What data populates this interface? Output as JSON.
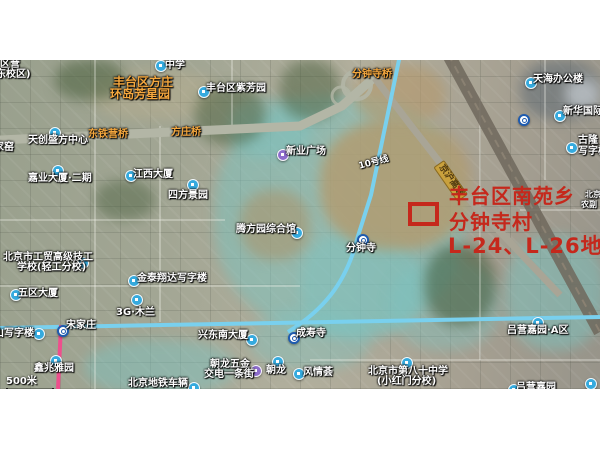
{
  "window": {
    "width": 600,
    "height": 450,
    "background": "#ffffff"
  },
  "map": {
    "type": "satellite-map",
    "scale_bar": {
      "label": "500米"
    },
    "metro_line_label": "10号线",
    "labels": [
      {
        "text": "区营",
        "x": 0,
        "y": 0,
        "cls": ""
      },
      {
        "text": "东校区)",
        "x": -4,
        "y": 10,
        "cls": ""
      },
      {
        "text": "中学",
        "x": 165,
        "y": 1,
        "cls": ""
      },
      {
        "text": "丰台区方庄",
        "x": 113,
        "y": 16,
        "cls": "orange",
        "size": 12
      },
      {
        "text": "环岛芳星园",
        "x": 110,
        "y": 28,
        "cls": "orange",
        "size": 12
      },
      {
        "text": "丰台区紫芳园",
        "x": 206,
        "y": 24,
        "cls": ""
      },
      {
        "text": "分钟寺桥",
        "x": 352,
        "y": 10,
        "cls": "orange"
      },
      {
        "text": "天海办公楼",
        "x": 533,
        "y": 15,
        "cls": ""
      },
      {
        "text": "新华国际广",
        "x": 563,
        "y": 47,
        "cls": ""
      },
      {
        "text": "古隆",
        "x": 578,
        "y": 76,
        "cls": ""
      },
      {
        "text": "写字楼",
        "x": 578,
        "y": 87,
        "cls": ""
      },
      {
        "text": "东铁营桥",
        "x": 88,
        "y": 70,
        "cls": "orange"
      },
      {
        "text": "方庄桥",
        "x": 171,
        "y": 68,
        "cls": "orange"
      },
      {
        "text": "天创盛方中心",
        "x": 28,
        "y": 76,
        "cls": ""
      },
      {
        "text": "家窑",
        "x": -6,
        "y": 83,
        "cls": ""
      },
      {
        "text": "新业广场",
        "x": 286,
        "y": 87,
        "cls": ""
      },
      {
        "text": "10号线",
        "x": 358,
        "y": 103,
        "cls": "metrolbl",
        "rot": -15
      },
      {
        "text": "京沪高速",
        "x": 444,
        "y": 100,
        "cls": "roadtag",
        "rot": 55
      },
      {
        "text": "嘉业大厦·二期",
        "x": 28,
        "y": 114,
        "cls": ""
      },
      {
        "text": "江西大厦",
        "x": 133,
        "y": 110,
        "cls": ""
      },
      {
        "text": "四方景园",
        "x": 168,
        "y": 131,
        "cls": ""
      },
      {
        "text": "北京",
        "x": 585,
        "y": 131,
        "cls": "",
        "size": 8
      },
      {
        "text": "农副",
        "x": 581,
        "y": 141,
        "cls": "",
        "size": 8
      },
      {
        "text": "腾方园综合馆",
        "x": 236,
        "y": 165,
        "cls": ""
      },
      {
        "text": "分钟寺",
        "x": 346,
        "y": 184,
        "cls": ""
      },
      {
        "text": "北京市工贸高级技工",
        "x": 3,
        "y": 193,
        "cls": ""
      },
      {
        "text": "学校(轻工分校)",
        "x": 17,
        "y": 203,
        "cls": ""
      },
      {
        "text": "金泰翔达写字楼",
        "x": 137,
        "y": 214,
        "cls": ""
      },
      {
        "text": "五区大厦",
        "x": 18,
        "y": 229,
        "cls": ""
      },
      {
        "text": "3G·木兰",
        "x": 116,
        "y": 248,
        "cls": ""
      },
      {
        "text": "宋家庄",
        "x": 66,
        "y": 261,
        "cls": ""
      },
      {
        "text": "山写字楼",
        "x": -6,
        "y": 269,
        "cls": ""
      },
      {
        "text": "兴东南大厦",
        "x": 198,
        "y": 271,
        "cls": ""
      },
      {
        "text": "成寿寺",
        "x": 296,
        "y": 269,
        "cls": ""
      },
      {
        "text": "吕营嘉园·A区",
        "x": 507,
        "y": 266,
        "cls": ""
      },
      {
        "text": "鑫兆雅园",
        "x": 34,
        "y": 304,
        "cls": ""
      },
      {
        "text": "朝龙五金",
        "x": 210,
        "y": 300,
        "cls": ""
      },
      {
        "text": "交电一条街",
        "x": 204,
        "y": 310,
        "cls": ""
      },
      {
        "text": "朝龙",
        "x": 266,
        "y": 306,
        "cls": ""
      },
      {
        "text": "风情荟",
        "x": 303,
        "y": 308,
        "cls": ""
      },
      {
        "text": "北京市第八十中学",
        "x": 368,
        "y": 307,
        "cls": ""
      },
      {
        "text": "(小红门分校)",
        "x": 377,
        "y": 317,
        "cls": ""
      },
      {
        "text": "北京地铁车辆",
        "x": 128,
        "y": 319,
        "cls": ""
      },
      {
        "text": "吕营嘉园",
        "x": 516,
        "y": 323,
        "cls": ""
      }
    ],
    "markers": [
      {
        "type": "poi-blue",
        "x": 155,
        "y": 0
      },
      {
        "type": "poi-blue",
        "x": 198,
        "y": 26
      },
      {
        "type": "poi-blue",
        "x": 525,
        "y": 17
      },
      {
        "type": "poi-blue",
        "x": 554,
        "y": 50
      },
      {
        "type": "poi-blue",
        "x": 566,
        "y": 82
      },
      {
        "type": "poi-blue",
        "x": 49,
        "y": 67
      },
      {
        "type": "poi-blue",
        "x": 52,
        "y": 105
      },
      {
        "type": "poi-blue",
        "x": 125,
        "y": 110
      },
      {
        "type": "poi-blue",
        "x": 187,
        "y": 119
      },
      {
        "type": "poi-purple",
        "x": 277,
        "y": 89
      },
      {
        "type": "poi-blue",
        "x": 291,
        "y": 167
      },
      {
        "type": "poi-blue",
        "x": 77,
        "y": 197
      },
      {
        "type": "poi-blue",
        "x": 128,
        "y": 215
      },
      {
        "type": "poi-blue",
        "x": 10,
        "y": 229
      },
      {
        "type": "poi-blue",
        "x": 131,
        "y": 234
      },
      {
        "type": "poi-blue",
        "x": 33,
        "y": 268
      },
      {
        "type": "poi-blue",
        "x": 246,
        "y": 274
      },
      {
        "type": "poi-blue",
        "x": 50,
        "y": 295
      },
      {
        "type": "poi-blue",
        "x": 272,
        "y": 296
      },
      {
        "type": "poi-blue",
        "x": 293,
        "y": 308
      },
      {
        "type": "poi-blue",
        "x": 401,
        "y": 297
      },
      {
        "type": "poi-purple",
        "x": 250,
        "y": 305
      },
      {
        "type": "poi-blue",
        "x": 188,
        "y": 322
      },
      {
        "type": "poi-blue",
        "x": 532,
        "y": 257
      },
      {
        "type": "poi-blue",
        "x": 508,
        "y": 324
      },
      {
        "type": "poi-blue",
        "x": 585,
        "y": 318
      },
      {
        "type": "metro",
        "x": 518,
        "y": 54
      },
      {
        "type": "metro",
        "x": 357,
        "y": 174
      },
      {
        "type": "metro",
        "x": 288,
        "y": 272
      },
      {
        "type": "metro",
        "x": 57,
        "y": 265
      }
    ]
  },
  "annotation": {
    "color": "#c5281c",
    "lines": [
      "丰台区南苑乡",
      "分钟寺村",
      "L-24、L-26地块"
    ],
    "parcel_box": {
      "x": 408,
      "y": 142,
      "w": 31,
      "h": 24
    }
  }
}
